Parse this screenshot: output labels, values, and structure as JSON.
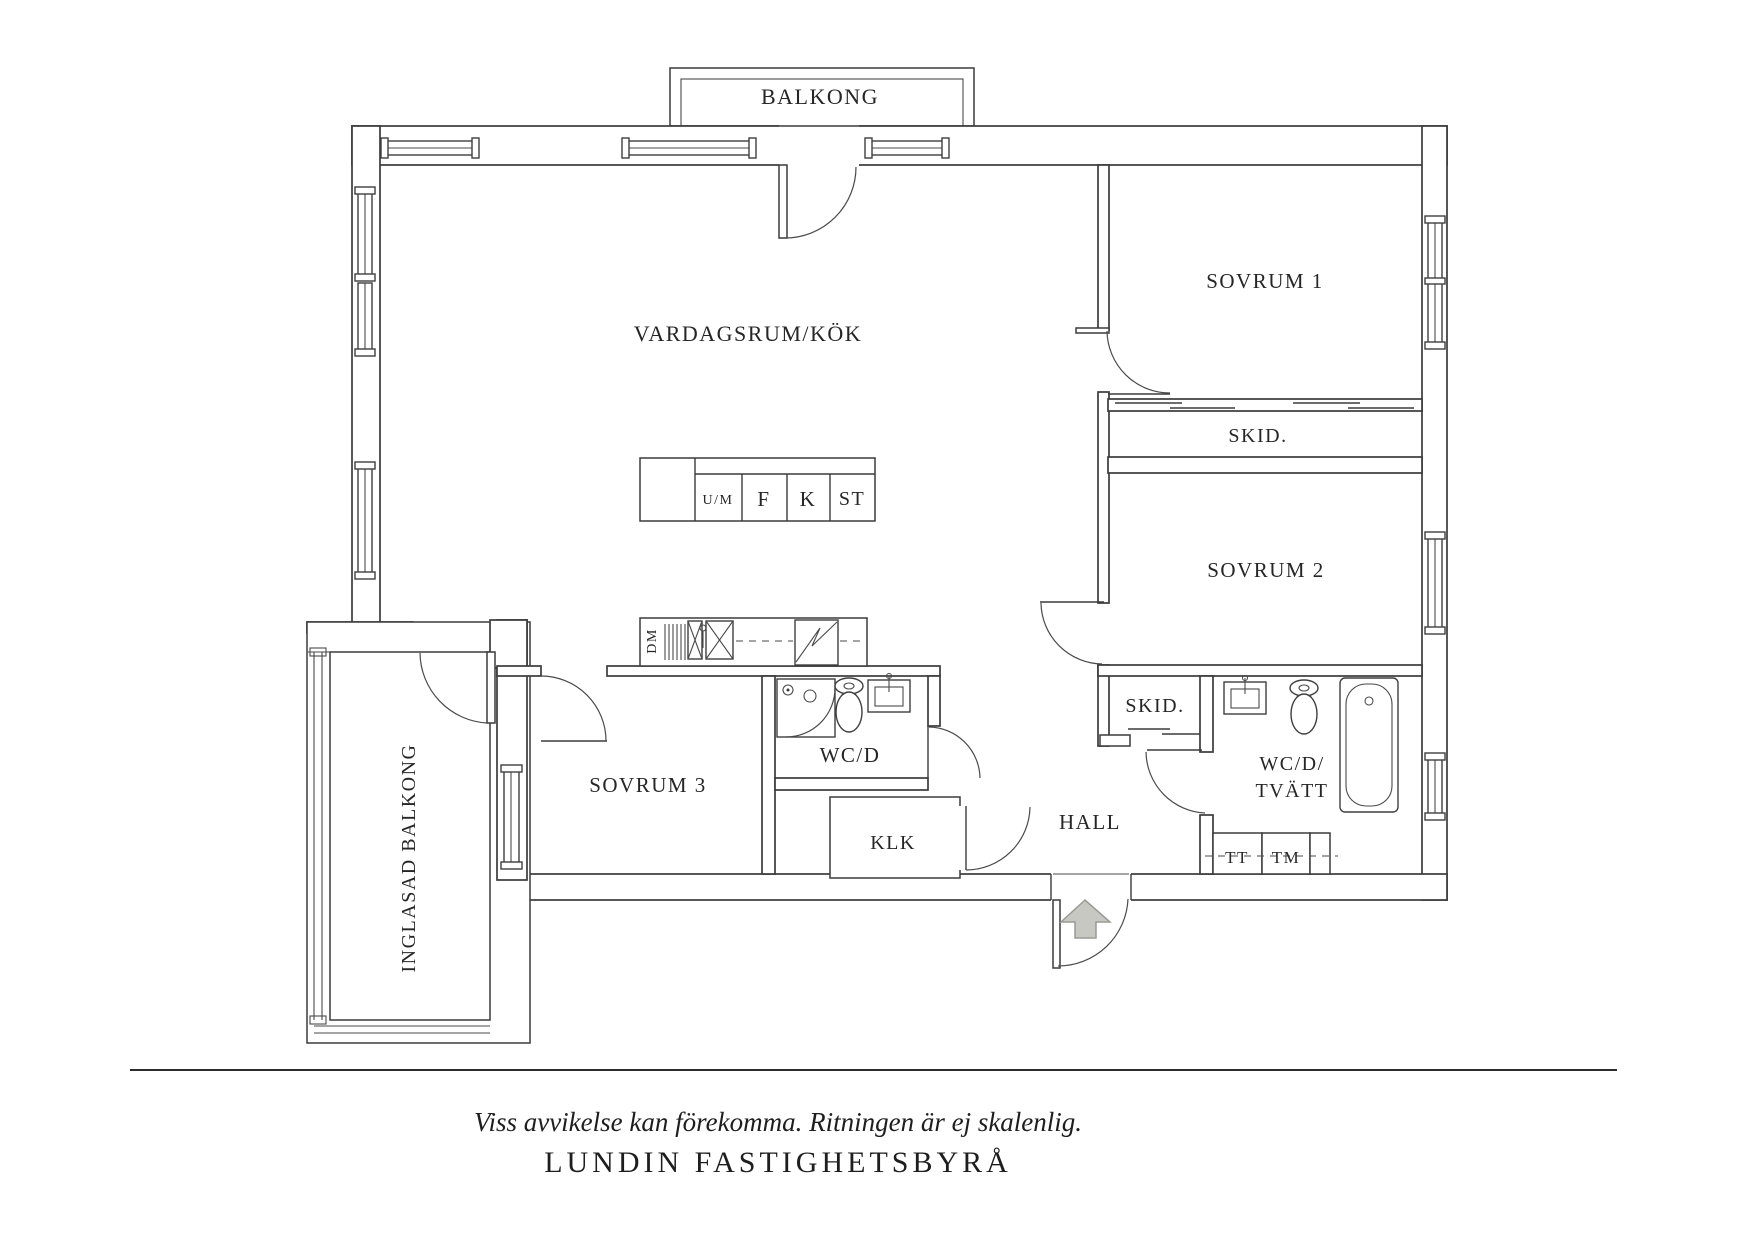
{
  "plan": {
    "rooms": {
      "balkong": "BALKONG",
      "vardagsrum": "VARDAGSRUM/KÖK",
      "sovrum1": "SOVRUM 1",
      "skid_upper": "SKID.",
      "sovrum2": "SOVRUM 2",
      "sovrum3": "SOVRUM 3",
      "wc_d": "WC/D",
      "klk": "KLK",
      "hall": "HALL",
      "skid_lower": "SKID.",
      "wc_d_tvatt_line1": "WC/D/",
      "wc_d_tvatt_line2": "TVÄTT",
      "inglasad_balkong": "INGLASAD BALKONG"
    },
    "kitchen": {
      "um": "U/M",
      "f": "F",
      "k": "K",
      "st": "ST",
      "dm": "DM"
    },
    "laundry": {
      "tt": "TT",
      "tm": "TM"
    },
    "colors": {
      "line": "#3b3b3b",
      "arrow_fill": "#c8c8c3",
      "arrow_stroke": "#9a9a96"
    }
  },
  "footer": {
    "disclaimer": "Viss avvikelse kan förekomma. Ritningen är ej skalenlig.",
    "brand": "LUNDIN FASTIGHETSBYRÅ"
  }
}
